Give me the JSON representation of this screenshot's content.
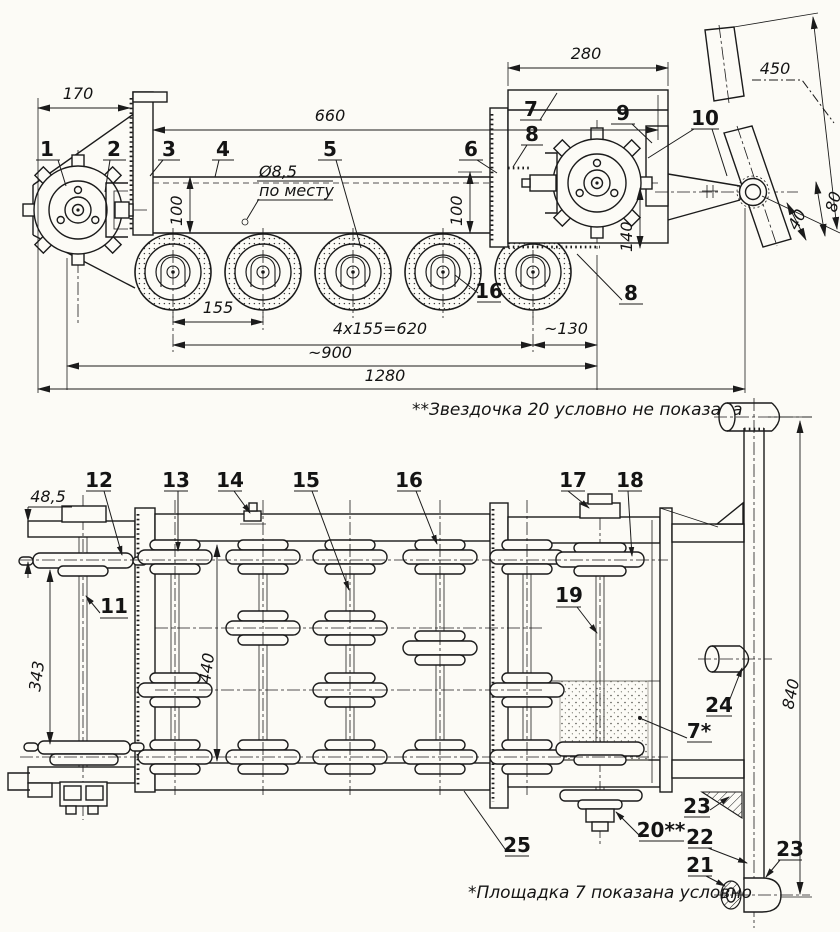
{
  "meta": {
    "title": "Двухпроекционный чертёж ходовой части (гусеничное шасси)"
  },
  "notes": {
    "sprocket_note": "**Звездочка 20 условно не показана",
    "platform_note": "*Площадка 7 показана условно"
  },
  "side_view": {
    "dimensions": {
      "d170": "170",
      "d660": "660",
      "d280": "280",
      "d450": "450",
      "d80": "80",
      "d40": "40",
      "d100_left": "100",
      "d100_right": "100",
      "d140": "140",
      "hole": "Ø8,5",
      "hole_note": "по месту",
      "d155": "155",
      "d620": "4x155=620",
      "d130": "~130",
      "d900": "~900",
      "d1280": "1280"
    },
    "callouts": {
      "c1": "1",
      "c2": "2",
      "c3": "3",
      "c4": "4",
      "c5": "5",
      "c6": "6",
      "c7": "7",
      "c8": "8",
      "c9": "9",
      "c10": "10",
      "c16": "16",
      "c8b": "8"
    }
  },
  "plan_view": {
    "dimensions": {
      "d48_5": "48,5",
      "d343": "343",
      "d440": "440",
      "d840": "840"
    },
    "callouts": {
      "c11": "11",
      "c12": "12",
      "c13": "13",
      "c14": "14",
      "c15": "15",
      "c16": "16",
      "c17": "17",
      "c18": "18",
      "c19": "19",
      "c20": "20**",
      "c21": "21",
      "c22": "22",
      "c23a": "23",
      "c23b": "23",
      "c24": "24",
      "c25": "25",
      "c7": "7*"
    }
  }
}
